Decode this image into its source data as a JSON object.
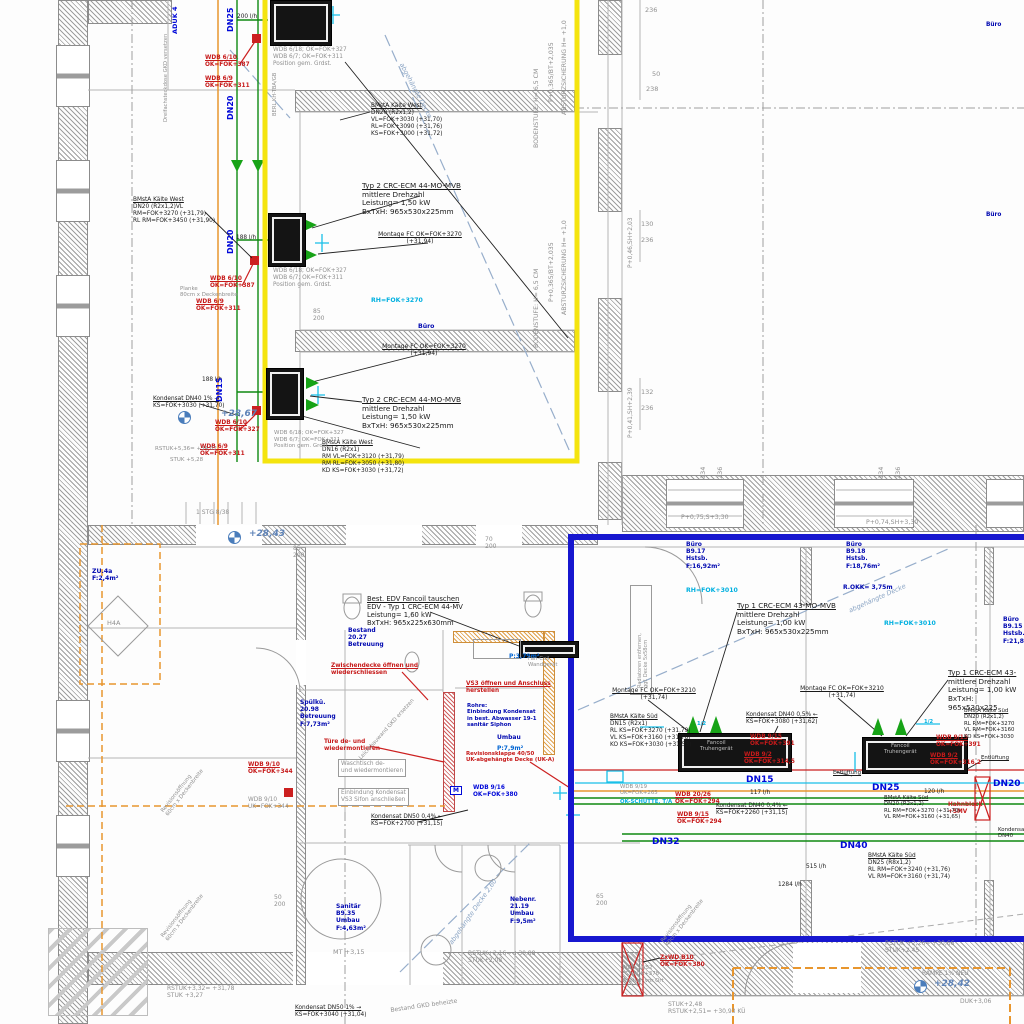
{
  "drawing": {
    "kind": "HVAC / Kälte Installationsplan (CAD-Ausschnitt)",
    "language": "de",
    "highlight_zones": {
      "yellow_outline_color": "#f4e40e",
      "blue_outline_color": "#1717cf"
    },
    "colors": {
      "pipe_green": "#0f8a12",
      "pipe_red": "#cc2020",
      "pipe_cyan": "#18c0e8",
      "pipe_orange": "#e8962e",
      "annotation_red": "#c61a1a",
      "room_blue": "#0008b0",
      "level_blue": "#5e83b8",
      "construction_grey": "#8f8f8f"
    }
  },
  "labels": [
    {
      "t": "BMstA Kälte West\nDN20 (R2x1,2)\nVL=FOK+3030 (+31,70)\nRL=FOK+3090 (+31,76)\nKS=FOK+3000 (+31,72)",
      "x": 371,
      "y": 103,
      "c": "k u",
      "fs": 5.8
    },
    {
      "t": "WDB 6/10\nOK=FOK+387",
      "x": 205,
      "y": 55,
      "c": "r u",
      "fs": 5.8
    },
    {
      "t": "WDB 6/9\nOK=FOK+311",
      "x": 205,
      "y": 76,
      "c": "r u",
      "fs": 5.8
    },
    {
      "t": "WDB 6/18; OK=FOK+327\nWDB 6/7; OK=FOK+311\nPosition gem. Grdst.",
      "x": 273,
      "y": 47,
      "c": "g",
      "fs": 5.8
    },
    {
      "t": "200 l/h",
      "x": 237,
      "y": 14,
      "c": "k",
      "fs": 5.8
    },
    {
      "t": "Typ 2  CRC-ECM 44-MO-MVB\nmittlere Drehzahl\nLeistung= 1,50 kW\nBxTxH: 965x530x225mm",
      "x": 362,
      "y": 182,
      "c": "k u",
      "fs": 7.2
    },
    {
      "t": "Montage FC OK=FOK+3270\n(+31,94)",
      "x": 376,
      "y": 231,
      "c": "k u ctr",
      "fs": 6
    },
    {
      "t": "BMstA Kälte West\nDN20 (R2x1,2)VL\nRM=FOK+3270 (+31,79)\nRL RM=FOK+3450 (+31,90)",
      "x": 133,
      "y": 197,
      "c": "k u",
      "fs": 5.8
    },
    {
      "t": "188 l/h",
      "x": 236,
      "y": 235,
      "c": "k",
      "fs": 5.8
    },
    {
      "t": "WDB 6/10\nOK=FOK+387",
      "x": 210,
      "y": 276,
      "c": "r u",
      "fs": 5.8
    },
    {
      "t": "WDB 6/9\nOK=FOK+311",
      "x": 196,
      "y": 299,
      "c": "r u",
      "fs": 5.8
    },
    {
      "t": "WDB 6/18; OK=FOK+327\nWDB 6/7; OK=FOK+311\nPosition gem. Grdst.",
      "x": 273,
      "y": 268,
      "c": "g",
      "fs": 5.8
    },
    {
      "t": "Planke\n80cm x Deckenbreite",
      "x": 180,
      "y": 286,
      "c": "g",
      "fs": 5.4
    },
    {
      "t": "RH=FOK+3270",
      "x": 371,
      "y": 297,
      "c": "c",
      "fs": 6.2
    },
    {
      "t": "Büro",
      "x": 418,
      "y": 323,
      "c": "room",
      "fs": 6.2
    },
    {
      "t": "Montage FC OK=FOK+3270\n(+31,94)",
      "x": 380,
      "y": 343,
      "c": "k u ctr",
      "fs": 6
    },
    {
      "t": "Typ 2  CRC-ECM 44-MO-MVB\nmittlere Drehzahl\nLeistung= 1,50 kW\nBxTxH: 965x530x225mm",
      "x": 362,
      "y": 396,
      "c": "k u",
      "fs": 7.2
    },
    {
      "t": "Kondensat DN40 1% →\nKS=FOK+3030 (+31,70)",
      "x": 153,
      "y": 396,
      "c": "k u",
      "fs": 5.8
    },
    {
      "t": "188 l/h",
      "x": 202,
      "y": 377,
      "c": "k",
      "fs": 5.8
    },
    {
      "t": "+28,67",
      "x": 221,
      "y": 409,
      "c": "lvl",
      "fs": 9
    },
    {
      "t": "WDB 6/10\nOK=FOK+327",
      "x": 215,
      "y": 420,
      "c": "r u",
      "fs": 5.8
    },
    {
      "t": "WDB 6/9\nOK=FOK+311",
      "x": 200,
      "y": 444,
      "c": "r u",
      "fs": 5.8
    },
    {
      "t": "RSTUK+5,36= +34,02",
      "x": 155,
      "y": 446,
      "c": "g",
      "fs": 5.5
    },
    {
      "t": "STUK +5,28",
      "x": 170,
      "y": 457,
      "c": "g",
      "fs": 5.5
    },
    {
      "t": "BMstA Kälte West\nDN16 (R2x1)\nRM VL=FOK+3120 (+31,79)\nRM RL=FOK+3050 (+31,80)\nKD KS=FOK+3030 (+31,72)",
      "x": 322,
      "y": 440,
      "c": "k u",
      "fs": 5.8
    },
    {
      "t": "WDB 6/18; OK=FOK+327\nWDB 6/7; OK=FOK+311\nPosition gem. Grdst.",
      "x": 274,
      "y": 430,
      "c": "g",
      "fs": 5.5
    },
    {
      "t": "236",
      "x": 645,
      "y": 7,
      "c": "dim",
      "fs": 6.5
    },
    {
      "t": "50",
      "x": 652,
      "y": 71,
      "c": "dim",
      "fs": 6.5
    },
    {
      "t": "238",
      "x": 646,
      "y": 86,
      "c": "dim",
      "fs": 6.5
    },
    {
      "t": "130",
      "x": 641,
      "y": 221,
      "c": "dim",
      "fs": 6.5
    },
    {
      "t": "236",
      "x": 641,
      "y": 237,
      "c": "dim",
      "fs": 6.5
    },
    {
      "t": "132",
      "x": 641,
      "y": 389,
      "c": "dim",
      "fs": 6.5
    },
    {
      "t": "236",
      "x": 641,
      "y": 405,
      "c": "dim",
      "fs": 6.5
    },
    {
      "t": "Büro",
      "x": 986,
      "y": 22,
      "c": "room",
      "fs": 5.8
    },
    {
      "t": "Büro",
      "x": 986,
      "y": 212,
      "c": "room",
      "fs": 5.8
    },
    {
      "t": "DN25",
      "x": 226,
      "y": 32,
      "c": "dn",
      "r": -90,
      "fs": 8
    },
    {
      "t": "DN20",
      "x": 226,
      "y": 120,
      "c": "dn",
      "r": -90,
      "fs": 8
    },
    {
      "t": "DN20",
      "x": 226,
      "y": 254,
      "c": "dn",
      "r": -90,
      "fs": 8
    },
    {
      "t": "DN15",
      "x": 215,
      "y": 402,
      "c": "dn",
      "r": -90,
      "fs": 8
    },
    {
      "t": "ADUK 4",
      "x": 172,
      "y": 34,
      "c": "dn",
      "r": -90,
      "fs": 6.5
    },
    {
      "t": "Dreifachsteckdose GKD versetzen",
      "x": 163,
      "y": 122,
      "c": "g",
      "r": -90,
      "fs": 5.2
    },
    {
      "t": "BERL KH-TBA/GB",
      "x": 272,
      "y": 116,
      "c": "g",
      "r": -90,
      "fs": 5.2
    },
    {
      "t": "BODENSTUFE: H= 6,5 CM",
      "x": 533,
      "y": 148,
      "c": "g",
      "r": -90,
      "fs": 6.2
    },
    {
      "t": "P+0,365/BT+2,035",
      "x": 548,
      "y": 102,
      "c": "g",
      "r": -90,
      "fs": 6.2
    },
    {
      "t": "ABSTURZSICHERUNG H= +1,0",
      "x": 561,
      "y": 115,
      "c": "g",
      "r": -90,
      "fs": 6.2
    },
    {
      "t": "BODENSTUFE: H= 6,5 CM",
      "x": 533,
      "y": 348,
      "c": "g",
      "r": -90,
      "fs": 6.2
    },
    {
      "t": "P+0,365/BT+2,035",
      "x": 548,
      "y": 302,
      "c": "g",
      "r": -90,
      "fs": 6.2
    },
    {
      "t": "ABSTURZSICHERUNG H= +1,0",
      "x": 561,
      "y": 315,
      "c": "g",
      "r": -90,
      "fs": 6.2
    },
    {
      "t": "P+0,46,SH+2,03",
      "x": 627,
      "y": 268,
      "c": "g",
      "r": -90,
      "fs": 6
    },
    {
      "t": "P+0,41,SH+2,39",
      "x": 627,
      "y": 438,
      "c": "g",
      "r": -90,
      "fs": 6
    },
    {
      "t": "134",
      "x": 700,
      "y": 479,
      "c": "dim",
      "r": -90,
      "fs": 6.5
    },
    {
      "t": "236",
      "x": 717,
      "y": 479,
      "c": "dim",
      "r": -90,
      "fs": 6.5
    },
    {
      "t": "134",
      "x": 878,
      "y": 479,
      "c": "dim",
      "r": -90,
      "fs": 6.5
    },
    {
      "t": "236",
      "x": 895,
      "y": 479,
      "c": "dim",
      "r": -90,
      "fs": 6.5
    },
    {
      "t": "P+0,75,S+3,30",
      "x": 681,
      "y": 514,
      "c": "g",
      "fs": 6.2
    },
    {
      "t": "P+0,74,SH+3,30",
      "x": 866,
      "y": 519,
      "c": "g",
      "fs": 6.2
    },
    {
      "t": "1 STG 8/38",
      "x": 196,
      "y": 509,
      "c": "g",
      "fs": 6
    },
    {
      "t": "+28,43",
      "x": 249,
      "y": 529,
      "c": "lvl",
      "fs": 9
    },
    {
      "t": "85\n200",
      "x": 313,
      "y": 308,
      "c": "dim",
      "fs": 6
    },
    {
      "t": "85\n200",
      "x": 293,
      "y": 545,
      "c": "dim",
      "fs": 6
    },
    {
      "t": "70\n200",
      "x": 485,
      "y": 536,
      "c": "dim",
      "fs": 6
    },
    {
      "t": "ZU.4a\nF:2,4m²",
      "x": 92,
      "y": 568,
      "c": "room",
      "fs": 6.2
    },
    {
      "t": "H4A",
      "x": 107,
      "y": 620,
      "c": "g",
      "fs": 6.5
    },
    {
      "t": "abgehängte Decke",
      "x": 404,
      "y": 62,
      "c": "dk",
      "r": 62,
      "fs": 6.5
    },
    {
      "t": "abgehängte Decke",
      "x": 848,
      "y": 608,
      "c": "dk",
      "r": -24,
      "fs": 6.5
    },
    {
      "t": "abgehängte Decke 2,60",
      "x": 448,
      "y": 942,
      "c": "dk",
      "r": -55,
      "fs": 6.5
    },
    {
      "t": "Büro\nB9.17\nHstsb.\nF:16,92m²",
      "x": 686,
      "y": 541,
      "c": "room",
      "fs": 6
    },
    {
      "t": "Büro\nB9.18\nHstsb.\nF:18,76m²",
      "x": 846,
      "y": 541,
      "c": "room",
      "fs": 6
    },
    {
      "t": "Büro\nB9.15\nHstsb.\nF:21,8m²",
      "x": 1003,
      "y": 616,
      "c": "room",
      "fs": 6
    },
    {
      "t": "R.OKK= 3,75m",
      "x": 843,
      "y": 584,
      "c": "room",
      "fs": 6
    },
    {
      "t": "RH=FOK+3010",
      "x": 686,
      "y": 587,
      "c": "c",
      "fs": 6.2
    },
    {
      "t": "RH=FOK+3010",
      "x": 884,
      "y": 620,
      "c": "c",
      "fs": 6.2
    },
    {
      "t": "Bestand\n20.27\nBetreuung",
      "x": 348,
      "y": 627,
      "c": "room",
      "fs": 6
    },
    {
      "t": "Spülkü.\n20.98\nBetreuung\nF:7,73m²",
      "x": 300,
      "y": 699,
      "c": "room",
      "fs": 6
    },
    {
      "t": "Sanitär\nB9.35\nUmbau\nF:4,63m²",
      "x": 336,
      "y": 903,
      "c": "room",
      "fs": 6
    },
    {
      "t": "Nebenr.\n21.19\nUmbau\nF:9,5m²",
      "x": 510,
      "y": 896,
      "c": "room",
      "fs": 6
    },
    {
      "t": "Rohre:\nEinbindung Kondensat\nin best. Abwasser 19-1\nsanitär Siphon",
      "x": 467,
      "y": 703,
      "c": "room",
      "fs": 5.4
    },
    {
      "t": "Umbau",
      "x": 497,
      "y": 734,
      "c": "room",
      "fs": 6
    },
    {
      "t": "P:7,9m²",
      "x": 497,
      "y": 745,
      "c": "lb",
      "fs": 6
    },
    {
      "t": "P:3,79m²",
      "x": 509,
      "y": 653,
      "c": "lb",
      "fs": 6
    },
    {
      "t": "Best. EDV Fancoil tauschen\nEDV - Typ 1   CRC-ECM 44-MV\nLeistung= 1,60 kW\nBxTxH: 965x225x630mm",
      "x": 367,
      "y": 595,
      "c": "k u",
      "fs": 6.8
    },
    {
      "t": "Fan-Coil\nWandgerät",
      "x": 528,
      "y": 656,
      "c": "g",
      "fs": 5.4
    },
    {
      "t": "Zwischendecke öffnen und\nwiederschliessen",
      "x": 331,
      "y": 663,
      "c": "r u",
      "fs": 5.8
    },
    {
      "t": "VS3 öffnen und Anschluss\nherstellen",
      "x": 466,
      "y": 681,
      "c": "r u",
      "fs": 5.8
    },
    {
      "t": "Türe de- und\nwiedermontieren",
      "x": 324,
      "y": 739,
      "c": "r",
      "fs": 5.8
    },
    {
      "t": "Waschtisch de-\nund wiedermontieren",
      "x": 338,
      "y": 759,
      "c": "g gbox",
      "fs": 5.8
    },
    {
      "t": "Einbindung Kondensat\nVS3 Sifon anschließen",
      "x": 338,
      "y": 788,
      "c": "g gbox",
      "fs": 5.8
    },
    {
      "t": "Revisionsklappe 40/50\nUK-abgehängte Decke (UK-A)",
      "x": 466,
      "y": 751,
      "c": "r",
      "fs": 5.4
    },
    {
      "t": "WDB 9/16\nOK=FOK+380",
      "x": 473,
      "y": 785,
      "c": "bb",
      "fs": 5.8
    },
    {
      "t": "WDB 9/10\nOK=FOK+344",
      "x": 248,
      "y": 762,
      "c": "r u",
      "fs": 5.8
    },
    {
      "t": "WDB 9/10\nUK=FOK+344",
      "x": 248,
      "y": 797,
      "c": "g",
      "fs": 5.8
    },
    {
      "t": "M",
      "x": 450,
      "y": 786,
      "c": "mb",
      "fs": 6
    },
    {
      "t": "Kondensat DN50 0,4% ←\nKS=FOK+2700 (+31,15)",
      "x": 371,
      "y": 814,
      "c": "k u",
      "fs": 5.8
    },
    {
      "t": "Leichtbauwand GKD ersetzen",
      "x": 358,
      "y": 757,
      "c": "g",
      "r": -48,
      "fs": 5.4
    },
    {
      "t": "Typ 1  CRC-ECM 43-MO-MVB\nmittlere Drehzahl\nLeistung= 1,00 kW\nBxTxH: 965x530x225mm",
      "x": 737,
      "y": 602,
      "c": "k u",
      "fs": 7.2
    },
    {
      "t": "Typ 1  CRC-ECM 43-\nmittlere Drehzahl\nLeistung= 1,00 kW\nBxTxH: 965x530x225",
      "x": 948,
      "y": 669,
      "c": "k u",
      "fs": 7.2
    },
    {
      "t": "Montage FC OK=FOK+3210\n(+31,74)",
      "x": 610,
      "y": 687,
      "c": "k u ctr",
      "fs": 6
    },
    {
      "t": "Montage FC OK=FOK+3210\n(+31,74)",
      "x": 798,
      "y": 685,
      "c": "k u ctr",
      "fs": 6
    },
    {
      "t": "BMstA Kälte Süd\nDN15 (R2x1)\nRL KS=FOK+3270 (+31,79)\nVL KS=FOK+3160 (+31,76)\nKO KS=FOK+3030 (+31,53)",
      "x": 610,
      "y": 714,
      "c": "k u",
      "fs": 5.8
    },
    {
      "t": "Kondensat DN40 0,5% ←\nKS=FOK+3080 (+31,62)",
      "x": 746,
      "y": 712,
      "c": "k u",
      "fs": 5.8
    },
    {
      "t": "WDB 9/15\nOK=FOK+391",
      "x": 750,
      "y": 734,
      "c": "r u",
      "fs": 5.8
    },
    {
      "t": "WDB 9/2\nOK=FOK+314,5",
      "x": 744,
      "y": 752,
      "c": "r u",
      "fs": 5.8
    },
    {
      "t": "WDB 9/15\nOK=FOK+391",
      "x": 936,
      "y": 735,
      "c": "r u",
      "fs": 5.8
    },
    {
      "t": "WDB 9/2\nOK=FOK+316,2",
      "x": 930,
      "y": 753,
      "c": "r u",
      "fs": 5.8
    },
    {
      "t": "Fancoil\nTruhengerät",
      "x": 700,
      "y": 740,
      "c": "gu",
      "fs": 5.4
    },
    {
      "t": "Fancoil\nTruhengerät",
      "x": 884,
      "y": 743,
      "c": "gu",
      "fs": 5.4
    },
    {
      "t": "Entlüftung",
      "x": 833,
      "y": 770,
      "c": "k u",
      "fs": 5.4
    },
    {
      "t": "Entlüftung",
      "x": 981,
      "y": 755,
      "c": "k u",
      "fs": 5.4
    },
    {
      "t": "DN15",
      "x": 746,
      "y": 775,
      "c": "dn",
      "fs": 9
    },
    {
      "t": "DN25",
      "x": 872,
      "y": 783,
      "c": "dn",
      "fs": 9
    },
    {
      "t": "DN20",
      "x": 993,
      "y": 779,
      "c": "dn",
      "fs": 9
    },
    {
      "t": "DN32",
      "x": 652,
      "y": 837,
      "c": "dn",
      "fs": 9
    },
    {
      "t": "DN40",
      "x": 840,
      "y": 841,
      "c": "dn",
      "fs": 9
    },
    {
      "t": "117 l/h",
      "x": 750,
      "y": 790,
      "c": "k",
      "fs": 5.8
    },
    {
      "t": "120 l/h",
      "x": 924,
      "y": 789,
      "c": "k",
      "fs": 5.8
    },
    {
      "t": "515 l/h",
      "x": 806,
      "y": 864,
      "c": "k",
      "fs": 5.8
    },
    {
      "t": "1284 l/h",
      "x": 778,
      "y": 882,
      "c": "k",
      "fs": 5.8
    },
    {
      "t": "WDB 20/26\nOK=FOK+294",
      "x": 675,
      "y": 792,
      "c": "r u",
      "fs": 5.8
    },
    {
      "t": "WDB 9/15\nOK=FOK+294",
      "x": 677,
      "y": 812,
      "c": "r u",
      "fs": 5.8
    },
    {
      "t": "WDB 9/19\nUK=FOK+265",
      "x": 620,
      "y": 784,
      "c": "g",
      "fs": 5.4
    },
    {
      "t": "OK-SCHÜTTE, T/A",
      "x": 620,
      "y": 799,
      "c": "c",
      "fs": 5.4
    },
    {
      "t": "Kondensat DN40 0,4% ←\nKS=FOK+2260 (+31,15)",
      "x": 716,
      "y": 803,
      "c": "k u",
      "fs": 5.8
    },
    {
      "t": "Hahnblock\n+SMV",
      "x": 948,
      "y": 802,
      "c": "r",
      "fs": 5.8
    },
    {
      "t": "BMstA Kälte Süd\nDN20 (R2x1,2)\nRL RM=FOK+3270 (+31,70)\nVL RM=FOK+3160 (+31,65)",
      "x": 884,
      "y": 795,
      "c": "k u",
      "fs": 5.4
    },
    {
      "t": "BMstA Kälte Süd\nDN25 (R8x1,2)\nRL RM=FOK+3240 (+31,76)\nVL RM=FOK+3160 (+31,74)",
      "x": 868,
      "y": 853,
      "c": "k u",
      "fs": 5.8
    },
    {
      "t": "BMstA Kälte Süd\nDN20 (R2x1,2)\nRL RM=FOK+3270\nVL RM=FOK+3160\nKO KS=FOK+3030",
      "x": 964,
      "y": 708,
      "c": "k u",
      "fs": 5.4
    },
    {
      "t": "1/2",
      "x": 697,
      "y": 721,
      "c": "c",
      "fs": 5.2
    },
    {
      "t": "1/2",
      "x": 924,
      "y": 719,
      "c": "c",
      "fs": 5.2
    },
    {
      "t": "Kondensat DN40",
      "x": 998,
      "y": 827,
      "c": "k",
      "fs": 5.4
    },
    {
      "t": "Radiatoren entfernen,\nggf. Decke 5x58cm",
      "x": 637,
      "y": 688,
      "c": "g",
      "r": -90,
      "fs": 5
    },
    {
      "t": "MT +3,15",
      "x": 333,
      "y": 949,
      "c": "g",
      "fs": 6.5
    },
    {
      "t": "RSTUK+2,16= +30,88\nSTUK+2,08",
      "x": 468,
      "y": 950,
      "c": "g",
      "fs": 6
    },
    {
      "t": "RSTUK+3,32= +31,78\nSTUK +3,27",
      "x": 167,
      "y": 985,
      "c": "g",
      "fs": 6
    },
    {
      "t": "RSTUK +2,26= +30,66\nSTUK+2,45",
      "x": 885,
      "y": 940,
      "c": "g",
      "fs": 6
    },
    {
      "t": "RAMPE 1% NEU",
      "x": 922,
      "y": 970,
      "c": "g",
      "fs": 6
    },
    {
      "t": "+28,42",
      "x": 934,
      "y": 979,
      "c": "lvl",
      "fs": 9
    },
    {
      "t": "DUK+3,06",
      "x": 960,
      "y": 998,
      "c": "g",
      "fs": 6
    },
    {
      "t": "STUK+2,48\nRSTUK+2,51= +30,93 KÜ",
      "x": 668,
      "y": 1001,
      "c": "g",
      "fs": 6
    },
    {
      "t": "ZxWD B10\nOK=FOK+380",
      "x": 660,
      "y": 955,
      "c": "r u",
      "fs": 5.8
    },
    {
      "t": "WDB 30/52\nFC=FOK+378\nPosition vor Ort",
      "x": 622,
      "y": 965,
      "c": "g",
      "fs": 5.4
    },
    {
      "t": "Kondensat DN50 1% →\nKS=FOK+3040 (+31,04)",
      "x": 295,
      "y": 1005,
      "c": "k u",
      "fs": 5.8
    },
    {
      "t": "Bestand GKD beheizte",
      "x": 390,
      "y": 1007,
      "c": "g",
      "r": -8,
      "fs": 6
    },
    {
      "t": "Revisionsöffnung\n60cm x Deckenbreite",
      "x": 160,
      "y": 810,
      "c": "g",
      "r": -52,
      "fs": 5.4
    },
    {
      "t": "Revisionsöffnung\n60cm x Deckenbreite",
      "x": 160,
      "y": 935,
      "c": "g",
      "r": -52,
      "fs": 5.4
    },
    {
      "t": "Revisionsöffnung\n40cm x Deckenbreite",
      "x": 660,
      "y": 940,
      "c": "g",
      "r": -52,
      "fs": 5.4
    },
    {
      "t": "50\n200",
      "x": 274,
      "y": 894,
      "c": "dim",
      "fs": 6
    },
    {
      "t": "65\n200",
      "x": 596,
      "y": 893,
      "c": "dim",
      "fs": 6
    }
  ]
}
